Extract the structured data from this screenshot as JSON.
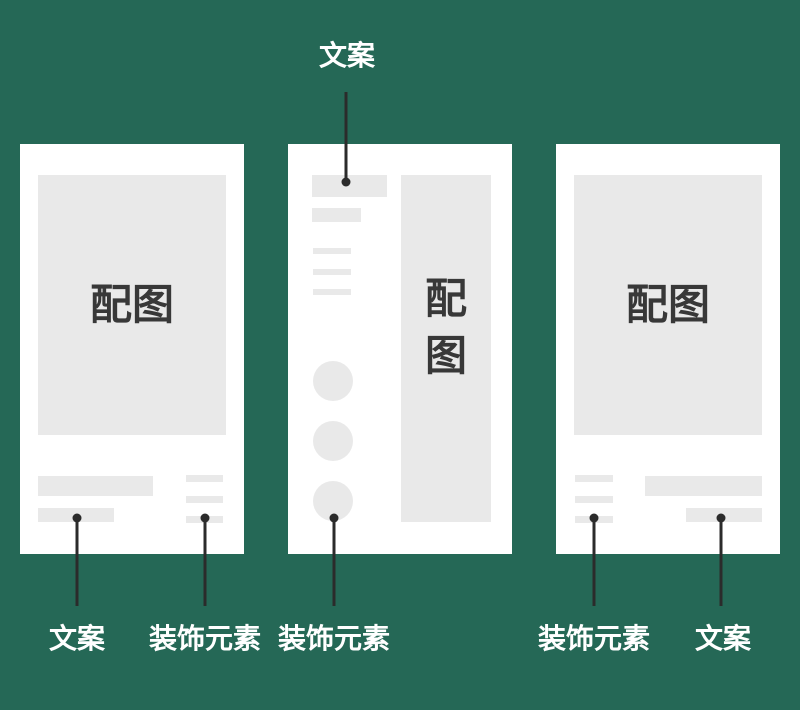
{
  "colors": {
    "background": "#256856",
    "card": "#ffffff",
    "placeholder": "#e9e9e9",
    "connector": "#2b2b2b",
    "placeholder_text": "#383838",
    "annotation_text": "#ffffff"
  },
  "cards": {
    "left": {
      "image_label": "配图"
    },
    "middle": {
      "image_label": "配\n图"
    },
    "right": {
      "image_label": "配图"
    }
  },
  "annotations": {
    "top": {
      "label": "文案"
    },
    "bottom": [
      {
        "label": "文案"
      },
      {
        "label": "装饰元素"
      },
      {
        "label": "装饰元素"
      },
      {
        "label": "装饰元素"
      },
      {
        "label": "文案"
      }
    ]
  }
}
